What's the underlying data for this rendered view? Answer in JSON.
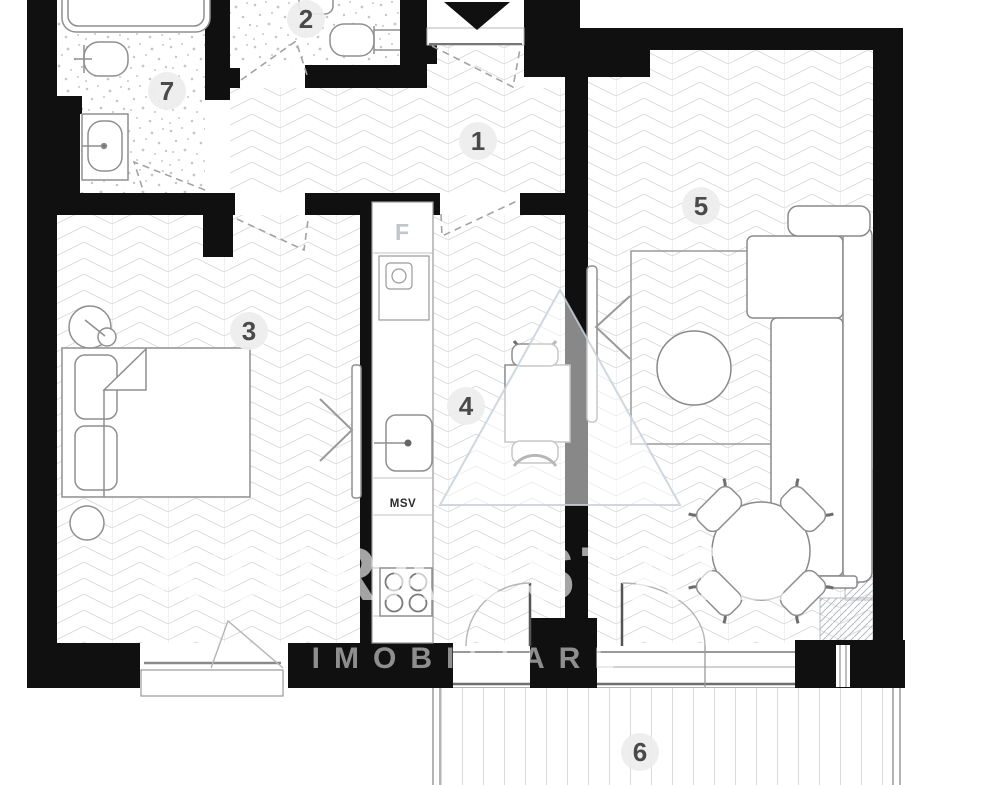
{
  "plan": {
    "title": "apartment floor plan",
    "rooms": [
      {
        "number": "1",
        "name": "hallway"
      },
      {
        "number": "2",
        "name": "wc"
      },
      {
        "number": "3",
        "name": "bedroom"
      },
      {
        "number": "4",
        "name": "kitchen"
      },
      {
        "number": "5",
        "name": "living-room"
      },
      {
        "number": "6",
        "name": "balcony"
      },
      {
        "number": "7",
        "name": "bathroom"
      }
    ],
    "fixture_labels": {
      "fridge": "F",
      "washer": "MSV"
    },
    "watermark": {
      "line1": "AZURA ESTATE",
      "line2": "IMOBILIARE"
    },
    "colors": {
      "wall": "#101010",
      "floor_line": "#dcdcdc",
      "furniture_stroke": "#8f8f8f",
      "label_bg": "#ededed",
      "label_text": "#4a4a4a",
      "fridge_label": "#c0c5c9",
      "washer_label": "#2b2b2b",
      "watermark": "#ced4da"
    }
  }
}
